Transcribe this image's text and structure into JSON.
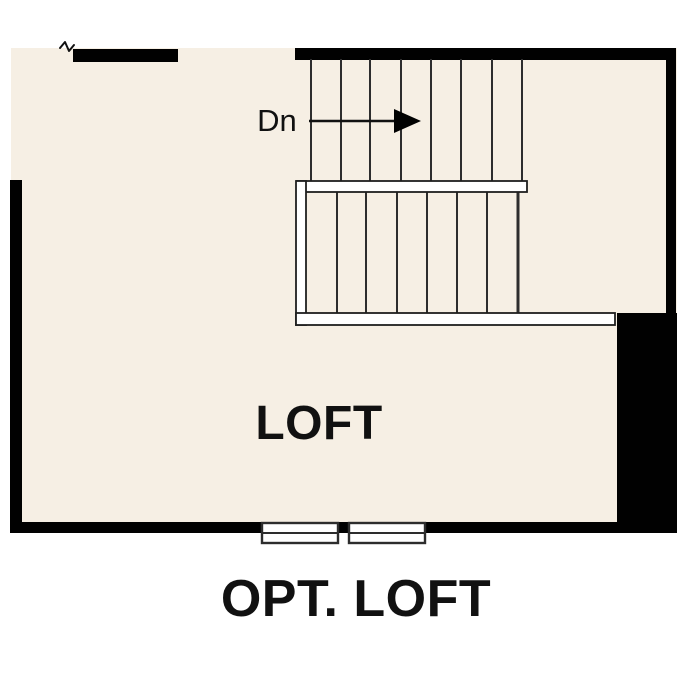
{
  "caption": "OPT. LOFT",
  "plan": {
    "room_label": "LOFT",
    "stairs": {
      "down_label": "Dn",
      "upper_run_tread_lines": 8,
      "lower_run_tread_lines": 7
    },
    "window_count": 2
  },
  "colors": {
    "floor": "#f6efe4",
    "wall": "#010101",
    "line": "#2d2d2d",
    "text": "#111111",
    "rail": "#ffffff",
    "background": "#ffffff"
  }
}
